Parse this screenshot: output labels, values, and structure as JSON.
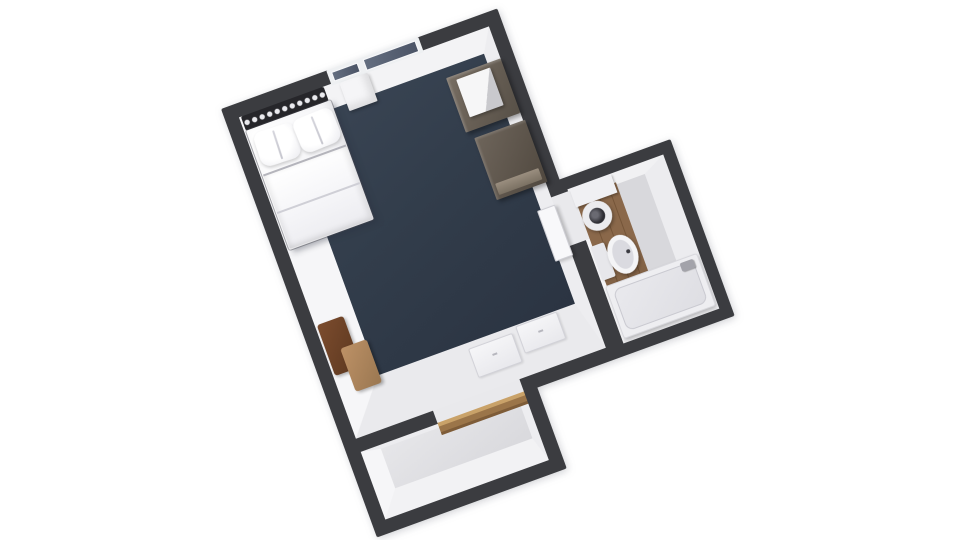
{
  "scene": {
    "type": "3d-floorplan-top-down-render",
    "rotation_deg": -20,
    "background": "#ffffff",
    "rooms": [
      {
        "id": "bedroom",
        "label": "Bedroom",
        "floor": "dark navy carpet",
        "furniture": [
          "window with two panes",
          "under-window cabinet",
          "studded headboard",
          "double bed with two pillows and duvet",
          "dresser with white tv-minifridge box",
          "media console",
          "two-tone wood armchair",
          "open bathroom door leaf",
          "two closet door panels"
        ]
      },
      {
        "id": "bathroom",
        "label": "Bathroom",
        "floor": "wood plank strip",
        "furniture": [
          "vanity counter",
          "round sink basin",
          "toilet",
          "bathtub",
          "faucet"
        ]
      },
      {
        "id": "entry",
        "label": "Entry vestibule",
        "floor": "light gray",
        "furniture": [
          "wood door threshold"
        ]
      }
    ]
  },
  "colors": {
    "bg": "#ffffff",
    "wall": "#3b3c40",
    "carpet": "#3a4554",
    "carpet_dark": "#2b3442",
    "floor_bath": "#d8d8dc",
    "floor_vest": "#d9d9dd",
    "wood": "#8a684a",
    "sill": "#9b7549",
    "sill_light": "#c9a269",
    "glass": "#646e80",
    "headboard": "#26262a",
    "stud": "#eaeaee",
    "bench_dark": "#7c4c2e",
    "bench_tan": "#bd9166",
    "dresser": "#776d62",
    "drain": "#2e2e34"
  }
}
